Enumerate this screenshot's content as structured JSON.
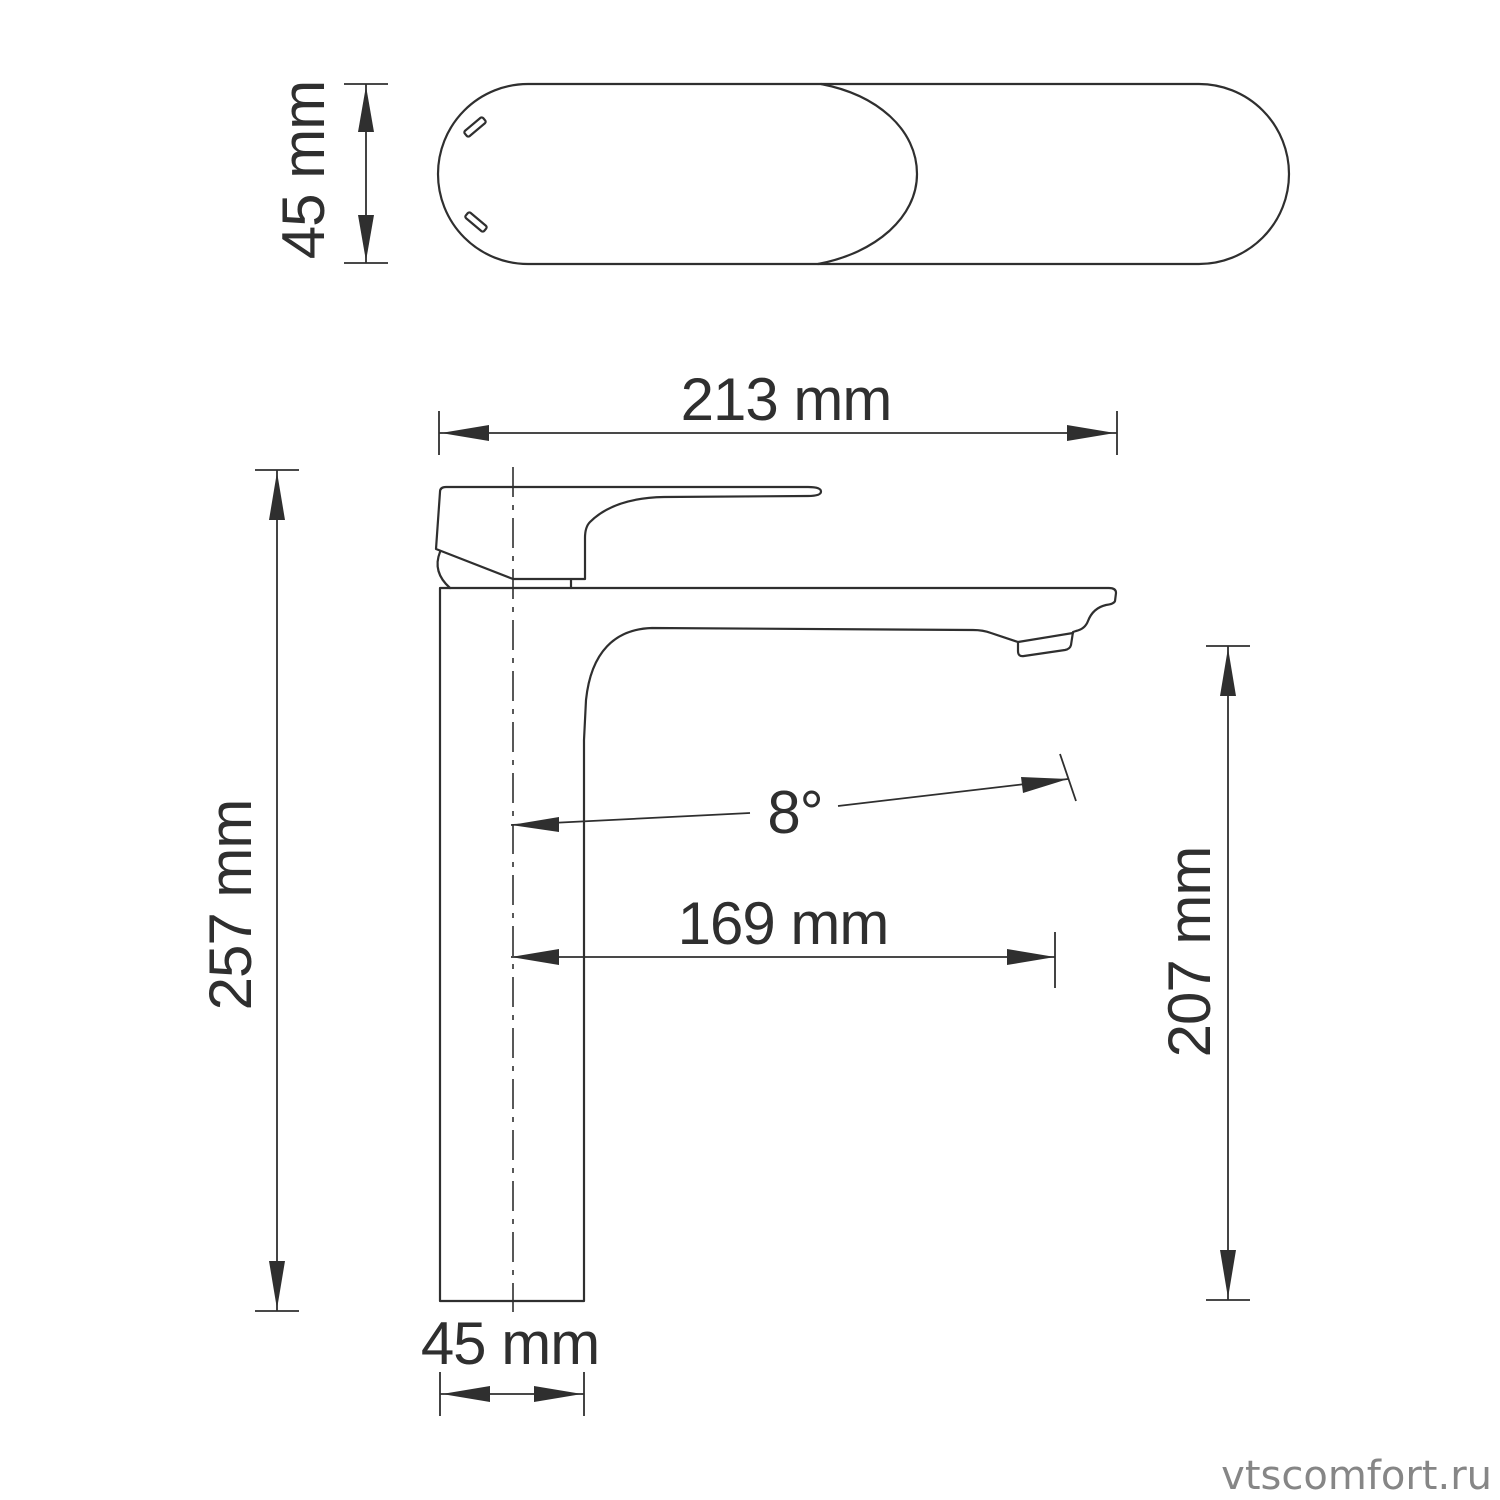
{
  "top_view": {
    "height_label": "45 mm"
  },
  "front_view": {
    "overall_width_label": "213 mm",
    "overall_height_label": "257 mm",
    "spout_angle_label": "8°",
    "spout_reach_label": "169 mm",
    "spout_height_label": "207 mm",
    "base_width_label": "45 mm"
  },
  "watermark": "vtscomfort.ru",
  "colors": {
    "line": "#2f2f2f",
    "watermark": "#868686",
    "background": "#ffffff"
  }
}
